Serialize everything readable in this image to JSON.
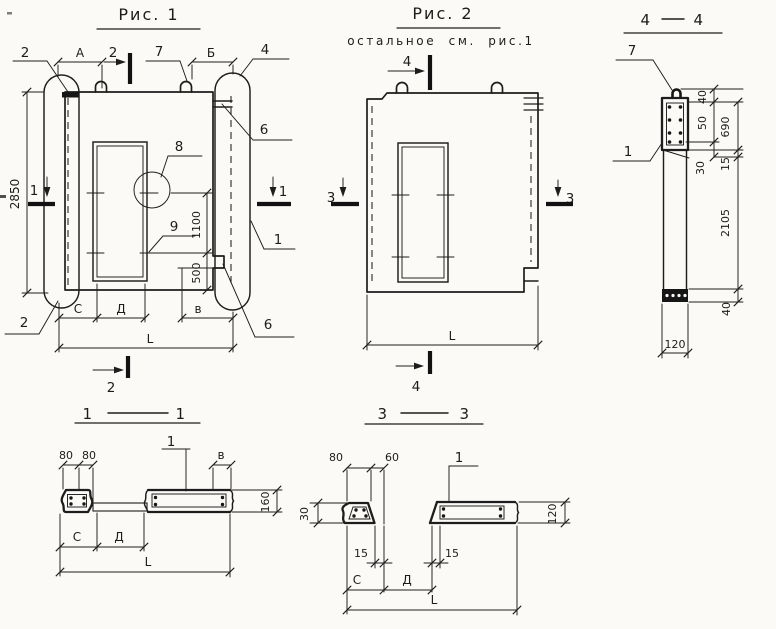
{
  "colors": {
    "paper": "#fbfaf7",
    "ink": "#1d1d1d"
  },
  "fig1": {
    "title": "Рис. 1",
    "callouts": {
      "c1": "1",
      "c2": "2",
      "c4": "4",
      "c6": "6",
      "c7": "7",
      "c8": "8",
      "c9": "9"
    },
    "sections": {
      "s1": "1",
      "s2": "2"
    },
    "dims": {
      "a": "А",
      "b": "Б",
      "h": "2850",
      "h1": "1100",
      "h2": "500",
      "c": "С",
      "d": "Д",
      "v": "в",
      "l": "L"
    }
  },
  "fig2": {
    "title": "Рис. 2",
    "subtitle": "остальное см. рис.1",
    "sections": {
      "s3": "3",
      "s4": "4"
    },
    "dims": {
      "l": "L"
    }
  },
  "sec44": {
    "num": "4",
    "callouts": {
      "c7": "7",
      "c1": "1"
    },
    "dims": {
      "d40t": "40",
      "d50": "50",
      "d690": "690",
      "d30": "30",
      "d15": "15",
      "d2105": "2105",
      "d40b": "40",
      "d120": "120"
    }
  },
  "sec11": {
    "num": "1",
    "callouts": {
      "c1": "1"
    },
    "dims": {
      "d80a": "80",
      "d80b": "80",
      "v": "в",
      "d160": "160",
      "c": "С",
      "d": "Д",
      "l": "L"
    }
  },
  "sec33": {
    "num": "3",
    "callouts": {
      "c1": "1"
    },
    "dims": {
      "d80": "80",
      "d60": "60",
      "d30": "30",
      "d120": "120",
      "d15a": "15",
      "d15b": "15",
      "c": "С",
      "d": "Д",
      "l": "L"
    }
  }
}
